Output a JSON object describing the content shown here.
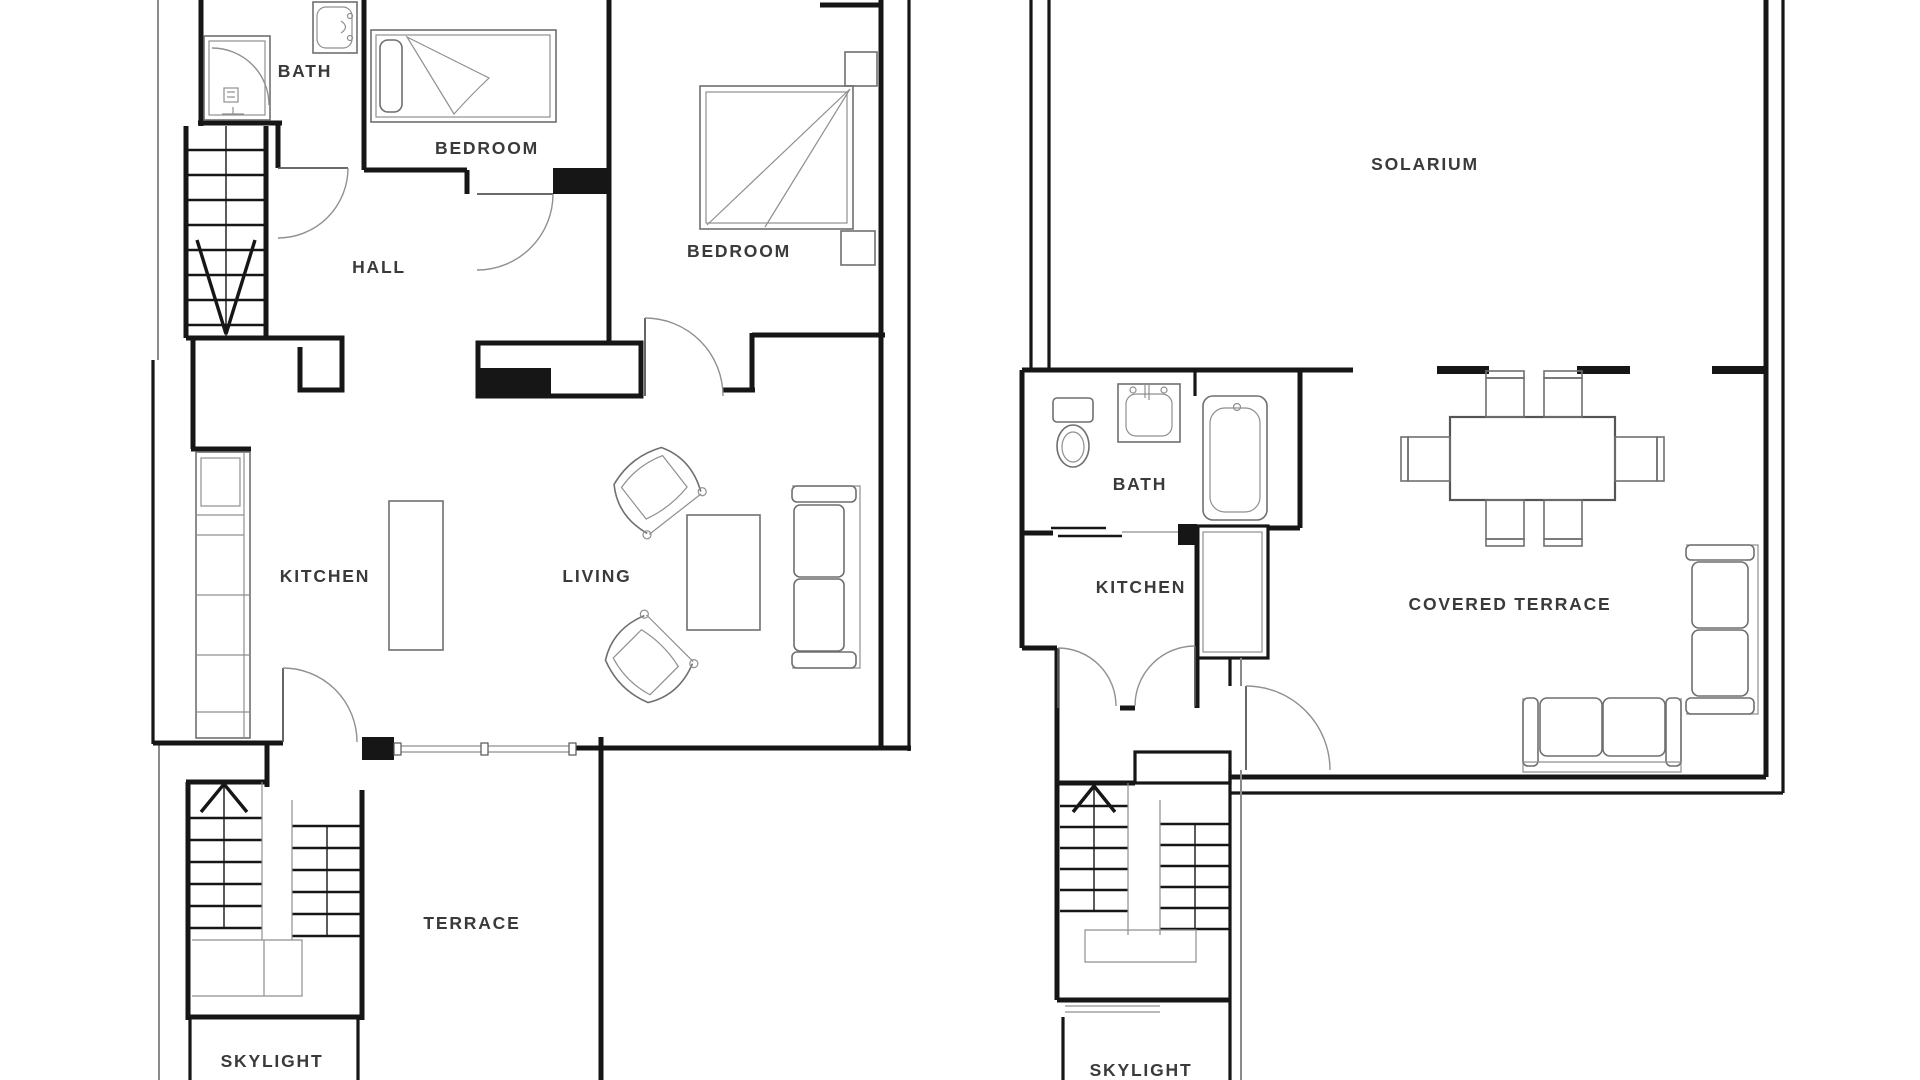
{
  "floorplan": {
    "colors": {
      "wall": "#161616",
      "furniture": "#6f6f6f",
      "label": "#3a3a3a",
      "background": "#ffffff"
    },
    "left_plan": {
      "labels": {
        "bath": "BATH",
        "bedroom_small": "BEDROOM",
        "hall": "HALL",
        "bedroom_large": "BEDROOM",
        "kitchen": "KITCHEN",
        "living": "LIVING",
        "terrace": "TERRACE",
        "skylight": "SKYLIGHT"
      }
    },
    "right_plan": {
      "labels": {
        "solarium": "SOLARIUM",
        "bath": "BATH",
        "kitchen": "KITCHEN",
        "covered_terrace": "COVERED TERRACE",
        "skylight": "SKYLIGHT"
      }
    }
  }
}
